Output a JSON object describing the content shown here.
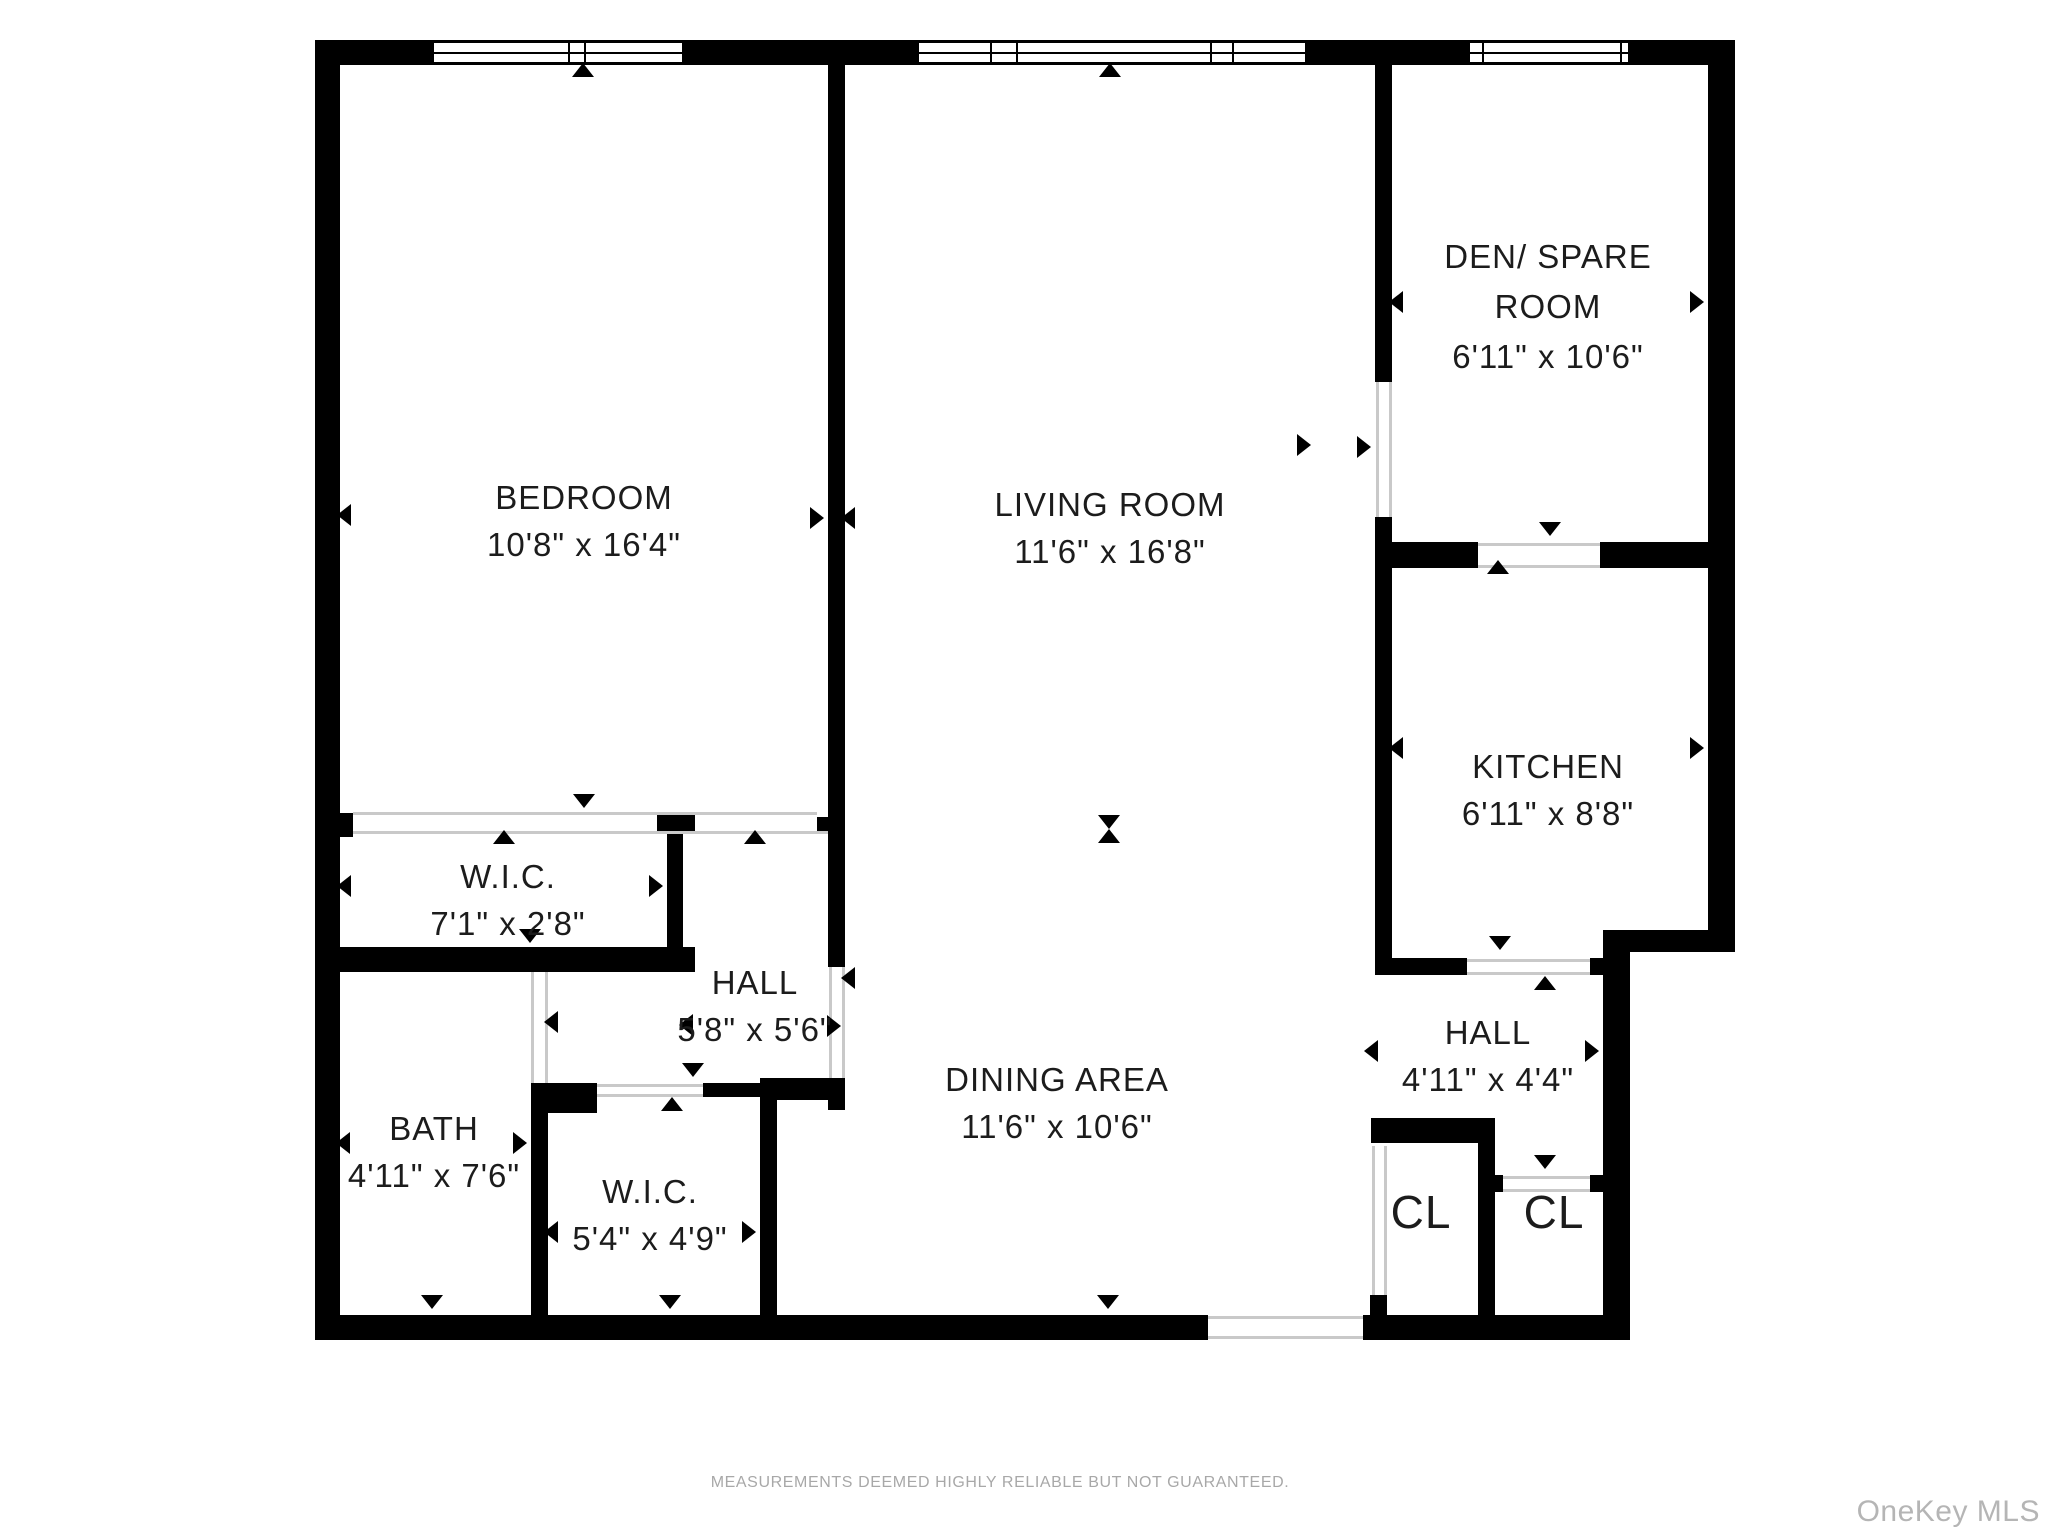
{
  "rooms": {
    "bedroom": {
      "name": "BEDROOM",
      "dims": "10'8\" x 16'4\""
    },
    "living": {
      "name": "LIVING ROOM",
      "dims": "11'6\" x 16'8\""
    },
    "den": {
      "name_line1": "DEN/ SPARE",
      "name_line2": "ROOM",
      "dims": "6'11\" x 10'6\""
    },
    "kitchen": {
      "name": "KITCHEN",
      "dims": "6'11\" x 8'8\""
    },
    "wic1": {
      "name": "W.I.C.",
      "dims": "7'1\" x 2'8\""
    },
    "hall1": {
      "name": "HALL",
      "dims": "5'8\" x 5'6\""
    },
    "bath": {
      "name": "BATH",
      "dims": "4'11\" x 7'6\""
    },
    "wic2": {
      "name": "W.I.C.",
      "dims": "5'4\" x 4'9\""
    },
    "dining": {
      "name": "DINING AREA",
      "dims": "11'6\" x 10'6\""
    },
    "hall2": {
      "name": "HALL",
      "dims": "4'11\" x 4'4\""
    },
    "closet_left": {
      "name": "CL"
    },
    "closet_right": {
      "name": "CL"
    }
  },
  "footer": {
    "disclaimer": "MEASUREMENTS DEEMED HIGHLY RELIABLE BUT NOT GUARANTEED."
  },
  "watermark": {
    "text": "OneKey MLS"
  },
  "colors": {
    "wall": "#000000",
    "opening_line": "#c9c9c9",
    "label": "#1c1c1c",
    "disclaimer": "#a8a8a8",
    "watermark": "#b5b5b5"
  }
}
